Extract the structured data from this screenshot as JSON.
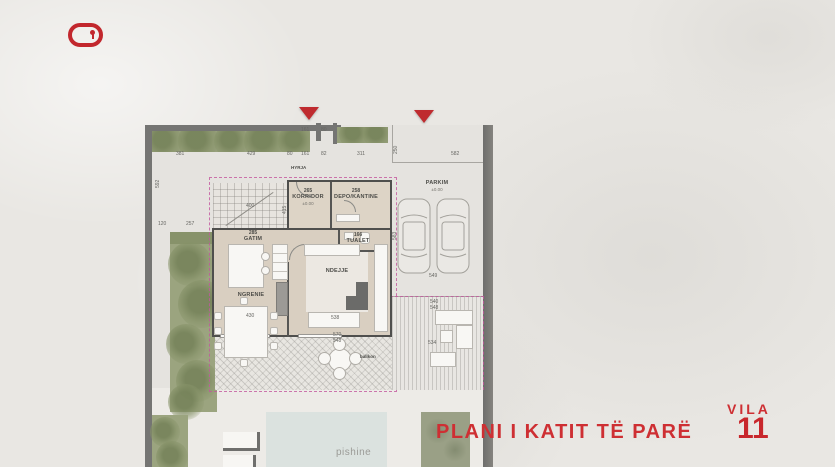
{
  "brand": {
    "logo_icon": "red-keyhole-pill"
  },
  "heading": {
    "plan_title": "PLANI I KATIT TË PARË",
    "villa_label": "VILA",
    "villa_number": "11"
  },
  "colors": {
    "accent_red": "#c2272d",
    "wall_gray": "#4f4f4d",
    "hedge_green": "#97a07c",
    "floor_tan": "#d9cfc1",
    "pool_blue": "#dbe2df",
    "boundary_pink": "#c4579e"
  },
  "rooms": {
    "hyrja": {
      "label": "HYRJA"
    },
    "korridor": {
      "number": "265",
      "label": "KORRIDOR",
      "sub": "±0.00"
    },
    "depo": {
      "number": "258",
      "label": "DEPO/KANTINE"
    },
    "gatim": {
      "number": "285",
      "label": "GATIM"
    },
    "tualet": {
      "number": "166",
      "label": "TUALET"
    },
    "ndejje": {
      "label": "NDEJJE"
    },
    "ngrenie": {
      "label": "NGRENIE"
    }
  },
  "outdoor": {
    "parkim": {
      "label": "PARKIM",
      "sub": "±0.00"
    },
    "ballkon": {
      "label": "ballkon"
    },
    "pishine": {
      "label": "pishine"
    }
  },
  "dims": {
    "d381": "381",
    "d429": "429",
    "d80a": "80",
    "d161a": "161",
    "d82": "82",
    "d311": "311",
    "d582": "582",
    "d161b": "161",
    "d80b": "80",
    "d592": "592",
    "d120": "120",
    "d257": "257",
    "d250": "250",
    "d583": "583",
    "d549": "549",
    "d540": "540",
    "d548a": "548",
    "d534": "534",
    "d570": "570",
    "d548b": "548",
    "d415": "415",
    "d430": "430",
    "d538": "538",
    "d400": "400"
  }
}
